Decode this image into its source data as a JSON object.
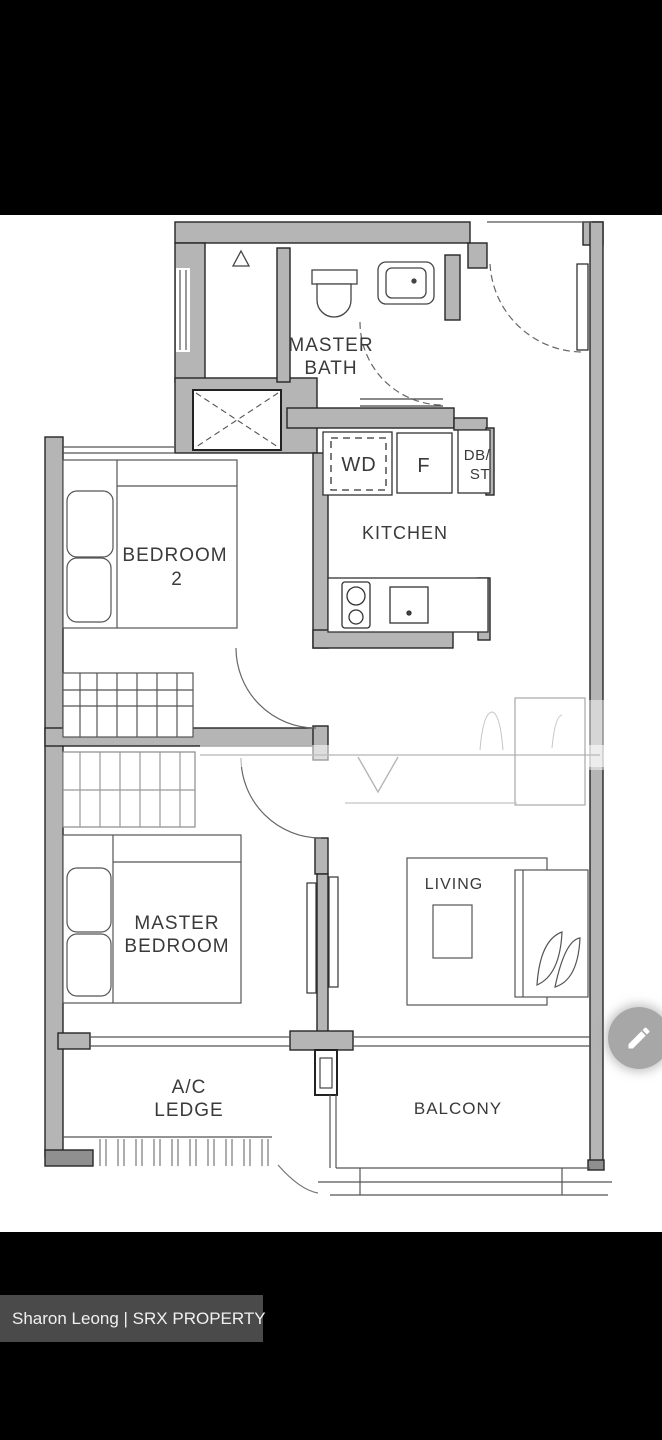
{
  "floorplan": {
    "rooms": {
      "master_bath": {
        "line1": "MASTER",
        "line2": "BATH"
      },
      "kitchen": {
        "label": "KITCHEN"
      },
      "bedroom2": {
        "line1": "BEDROOM",
        "line2": "2"
      },
      "master_bedroom": {
        "line1": "MASTER",
        "line2": "BEDROOM"
      },
      "living": {
        "label": "LIVING"
      },
      "ac_ledge": {
        "line1": "A/C",
        "line2": "LEDGE"
      },
      "balcony": {
        "label": "BALCONY"
      }
    },
    "appliances": {
      "washer_dryer": "WD",
      "fridge": "F",
      "db_st_line1": "DB/",
      "db_st_line2": "ST"
    },
    "colors": {
      "wall_fill": "#b5b5b5",
      "wall_outline": "#262626",
      "label_color": "#3a3a3a",
      "canvas_bg": "#ffffff",
      "letterbox_bg": "#000000"
    }
  },
  "overlay": {
    "caption": {
      "text": "Sharon Leong | SRX PROPERTY",
      "bg": "#4a4a4a",
      "color": "#f0f0f0"
    },
    "edit_button": {
      "icon": "pencil-icon"
    }
  }
}
